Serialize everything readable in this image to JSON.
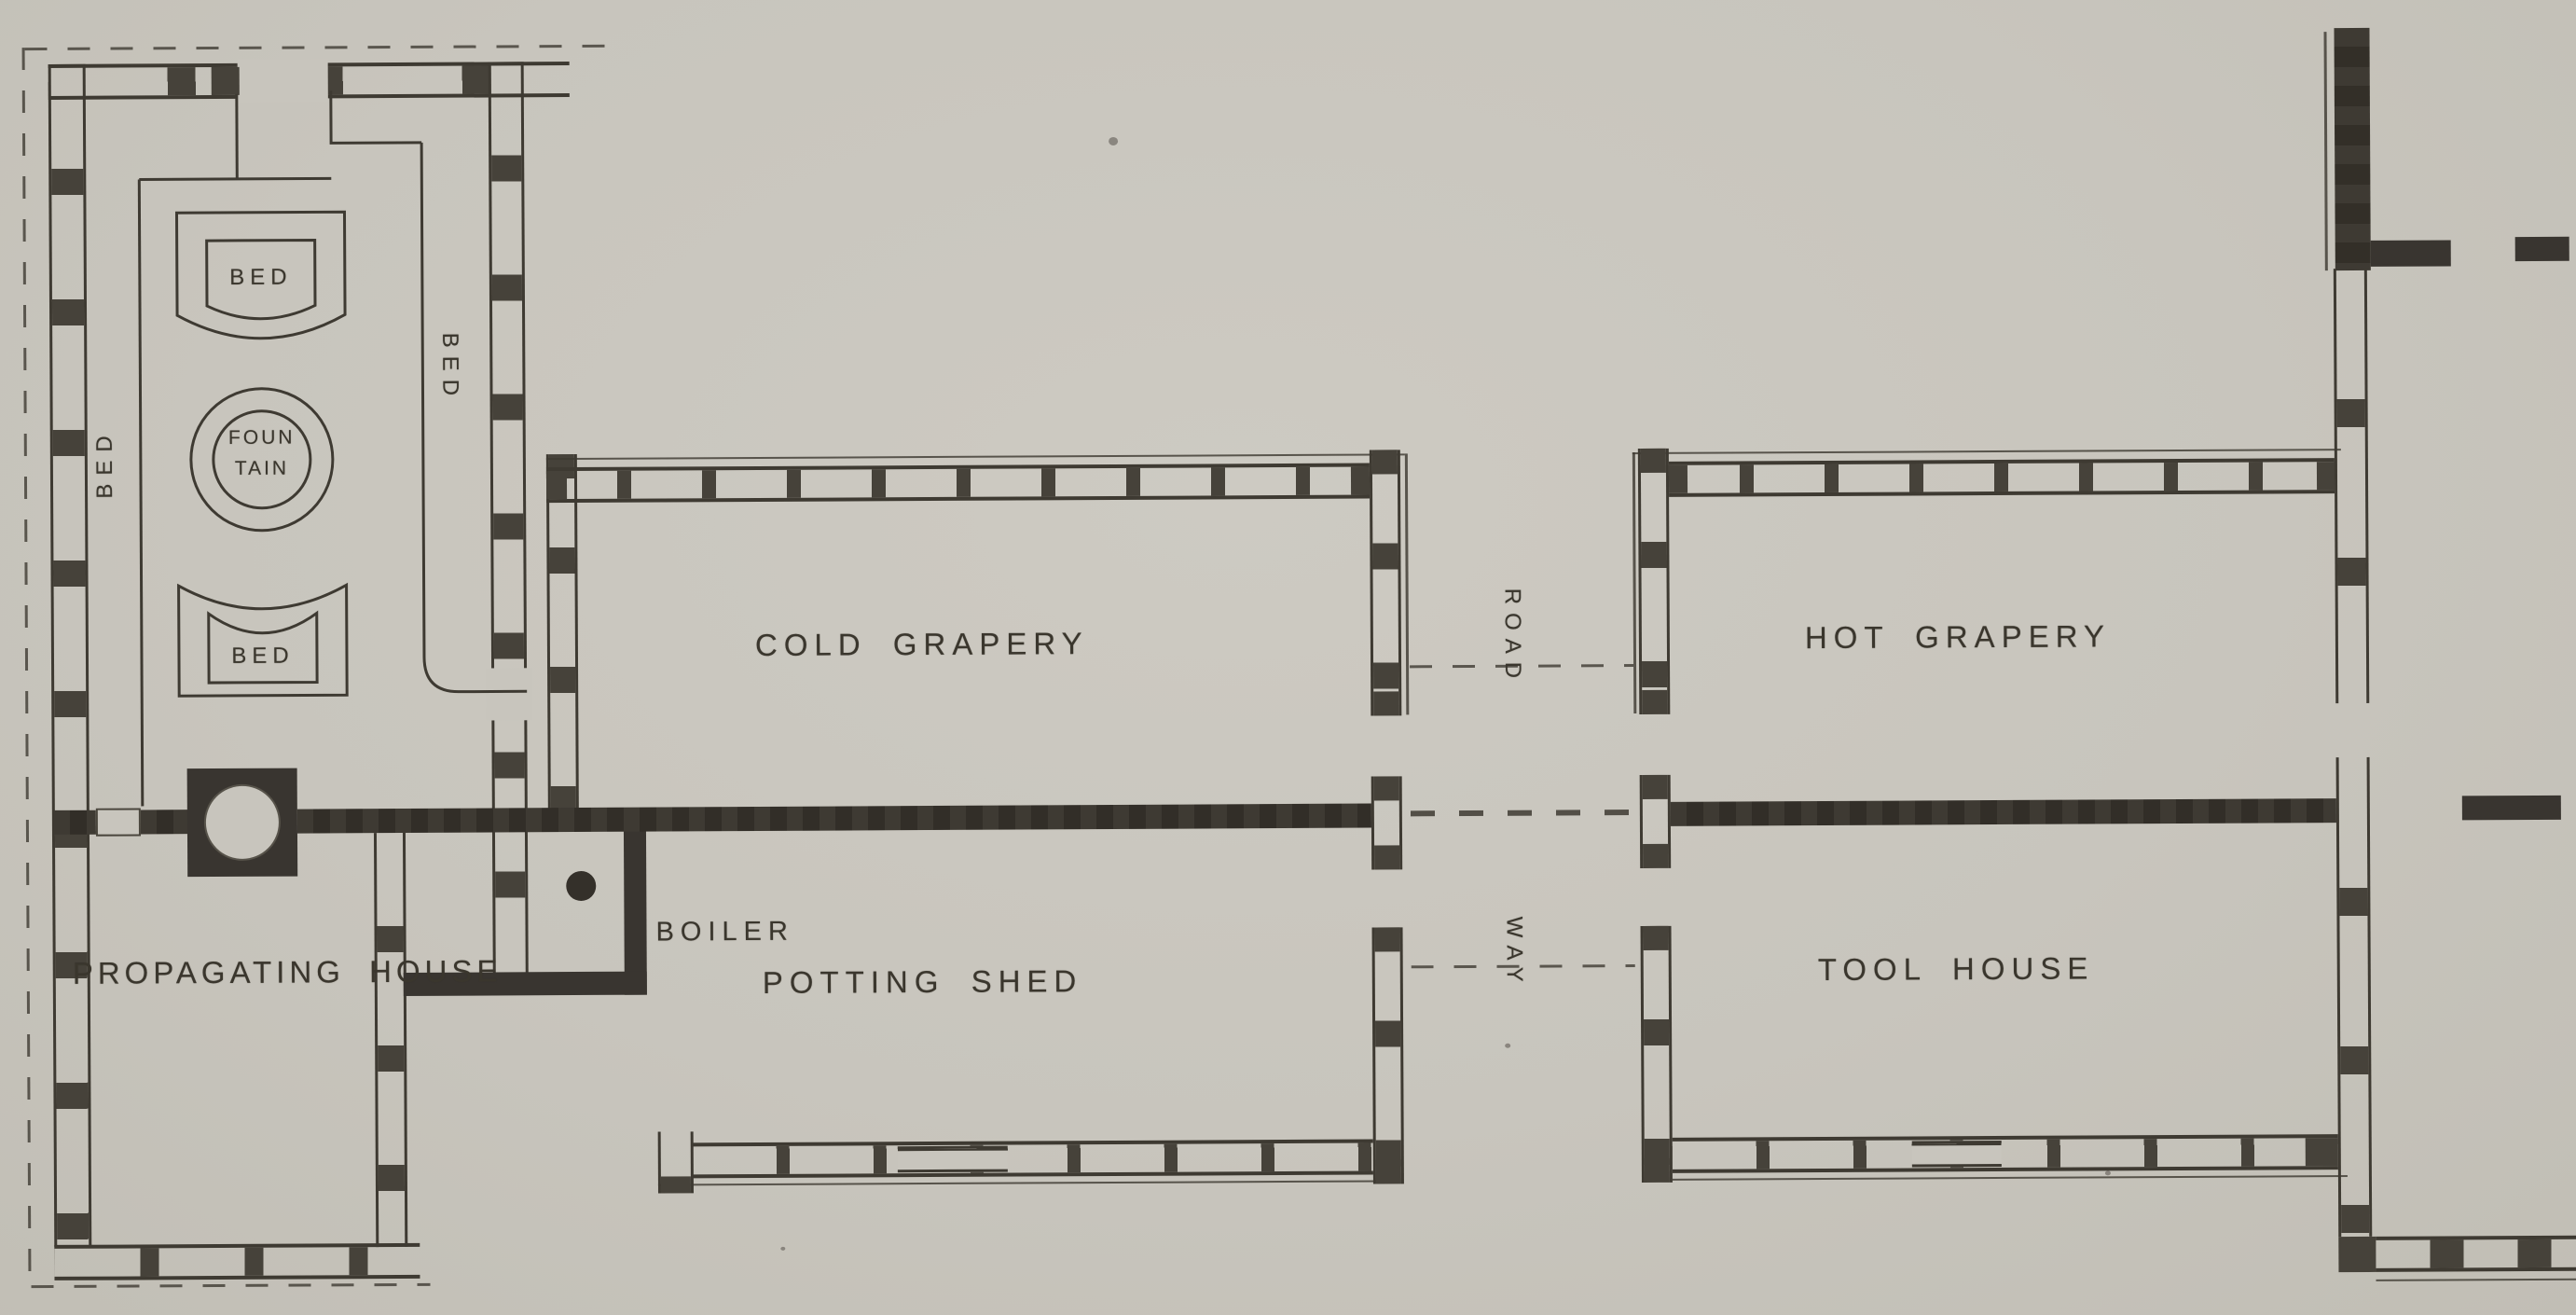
{
  "document": {
    "type": "scanned architectural floor plan",
    "description": "Plan of a range of garden glass houses: propagating house, cold and hot graperies, potting shed, tool house, boiler room, with road way between the blocks"
  },
  "colors": {
    "paper": "#c8c5bd",
    "ink": "#3e3a32",
    "wall_fill": "#46423a",
    "flue": "#393530",
    "text_ink": "#3a362d"
  },
  "rooms": {
    "propagating_house": {
      "label": "PROPAGATING HOUSE"
    },
    "cold_grapery": {
      "label": "COLD GRAPERY"
    },
    "hot_grapery": {
      "label": "HOT GRAPERY"
    },
    "potting_shed": {
      "label": "POTTING SHED"
    },
    "tool_house": {
      "label": "TOOL HOUSE"
    }
  },
  "features": {
    "boiler": {
      "label": "BOILER"
    },
    "fountain": {
      "line1": "FOUN",
      "line2": "TAIN"
    },
    "beds": {
      "top": "BED",
      "bottom": "BED",
      "left": "BED",
      "right": "BED"
    },
    "roadway": {
      "upper": "ROAD",
      "lower": "WAY"
    }
  }
}
